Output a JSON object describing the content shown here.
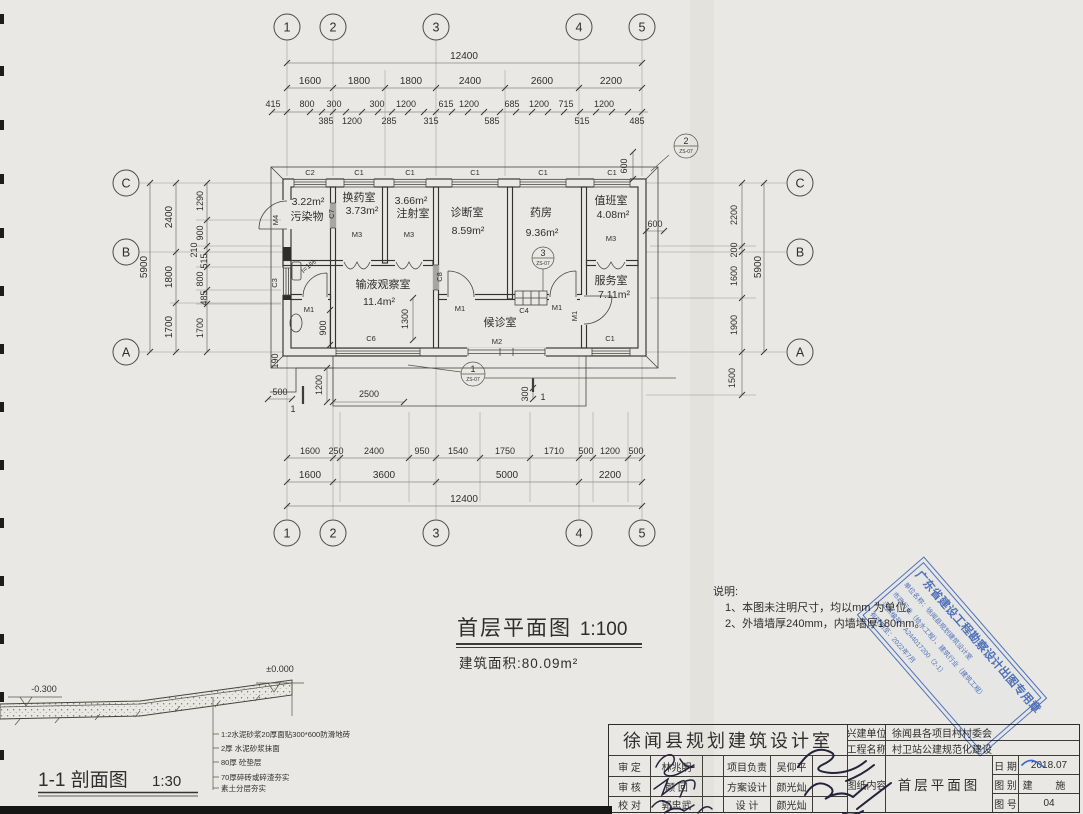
{
  "grid": {
    "cols": [
      "1",
      "2",
      "3",
      "4",
      "5"
    ],
    "rows": [
      "C",
      "B",
      "A"
    ]
  },
  "dims": {
    "top1": "12400",
    "top2": [
      "1600",
      "1800",
      "1800",
      "2400",
      "2600",
      "2200"
    ],
    "top3": [
      "415",
      "800",
      "300",
      "300",
      "1200",
      "615",
      "1200",
      "685",
      "1200",
      "715",
      "1200"
    ],
    "top4": [
      "385",
      "1200",
      "285",
      "315",
      "585",
      "515",
      "485"
    ],
    "bot1": [
      "1600",
      "250",
      "2400",
      "950",
      "1540",
      "1750",
      "1710",
      "500",
      "1200",
      "500"
    ],
    "bot2": [
      "1600",
      "3600",
      "5000",
      "2200"
    ],
    "bot3": "12400",
    "left1": "5900",
    "left2": [
      "2400",
      "1800",
      "1700"
    ],
    "left3": [
      "1290",
      "900",
      "210",
      "515",
      "800",
      "485",
      "1700"
    ],
    "left4": "190",
    "right1": "5900",
    "right2": [
      "2200",
      "200",
      "1600",
      "1900",
      "1500"
    ],
    "right3": "600",
    "right4": "600",
    "inner": {
      "d900": "900",
      "d1300": "1300",
      "d1200": "1200",
      "d2500": "2500",
      "d300": "300",
      "d500": "500"
    }
  },
  "rooms": [
    {
      "name": "污染物",
      "area": "3.22m²"
    },
    {
      "name": "换药室",
      "area": "3.73m²"
    },
    {
      "name": "注射室",
      "area": "3.66m²"
    },
    {
      "name": "诊断室",
      "area": "8.59m²"
    },
    {
      "name": "药房",
      "area": "9.36m²"
    },
    {
      "name": "值班室",
      "area": "4.08m²"
    },
    {
      "name": "输液观察室",
      "area": "11.4m²"
    },
    {
      "name": "候诊室",
      "area": ""
    },
    {
      "name": "服务室",
      "area": "7.11m²"
    }
  ],
  "openings": {
    "c1": "C1",
    "c2": "C2",
    "c3": "C3",
    "c4": "C4",
    "c6": "C6",
    "c7": "C7",
    "c8": "C8",
    "m1": "M1",
    "m2": "M2",
    "m3": "M3",
    "m4": "M4"
  },
  "slope": "i=1%",
  "marks": {
    "n1": "1",
    "n2": "2",
    "n3": "3",
    "ref": "ZS-07",
    "cut": "1"
  },
  "plan_title": {
    "text": "首层平面图",
    "scale": "1:100"
  },
  "area_note": "建筑面积:80.09m²",
  "notes": {
    "heading": "说明:",
    "item1": "1、本图未注明尺寸，均以mm 为单位。",
    "item2": "2、外墙墙厚240mm，内墙墙厚180mm。"
  },
  "section": {
    "title": "1-1 剖面图",
    "scale": "1:30",
    "lvl_left": "-0.300",
    "lvl_right": "±0.000",
    "layers": [
      "1:2水泥砂浆20厚面贴300*600防滑地砖",
      "2厚 水泥砂浆抹面",
      "80厚 砼垫层",
      "70厚碎砖或碎渣夯实",
      "素土分层夯实"
    ]
  },
  "stamp": {
    "title": "广东省建设工程勘察设计出图专用章",
    "line2": "单位名称：徐闻县规划建筑设计室",
    "line3": "市政行业（给水工程）、建筑行业（建筑工程）",
    "line4": "证书编号：A244017200（2-1）",
    "line5": "有效期至：2022年7月"
  },
  "titleblock": {
    "company": "徐闻县规划建筑设计室",
    "client_label": "兴建单位",
    "client": "徐闻县各项目村村委会",
    "project_label": "工程名称",
    "project": "村卫站公建规范化建设",
    "row1_label": "审 定",
    "row1_name": "林兆明",
    "row2_label": "审 核",
    "row2_name": "颜 回",
    "row3_label": "校 对",
    "row3_name": "郭忠武",
    "row4_label": "项目负责",
    "row4_name": "吴仰平",
    "row5_label": "方案设计",
    "row5_name": "颜光灿",
    "row6_label": "设 计",
    "row6_name": "颜光灿",
    "content_label": "图纸内容",
    "content": "首层平面图",
    "date_label": "日 期",
    "date": "2018.07",
    "type_label": "图 别",
    "type": "建 施",
    "no_label": "图 号",
    "no": "04"
  }
}
